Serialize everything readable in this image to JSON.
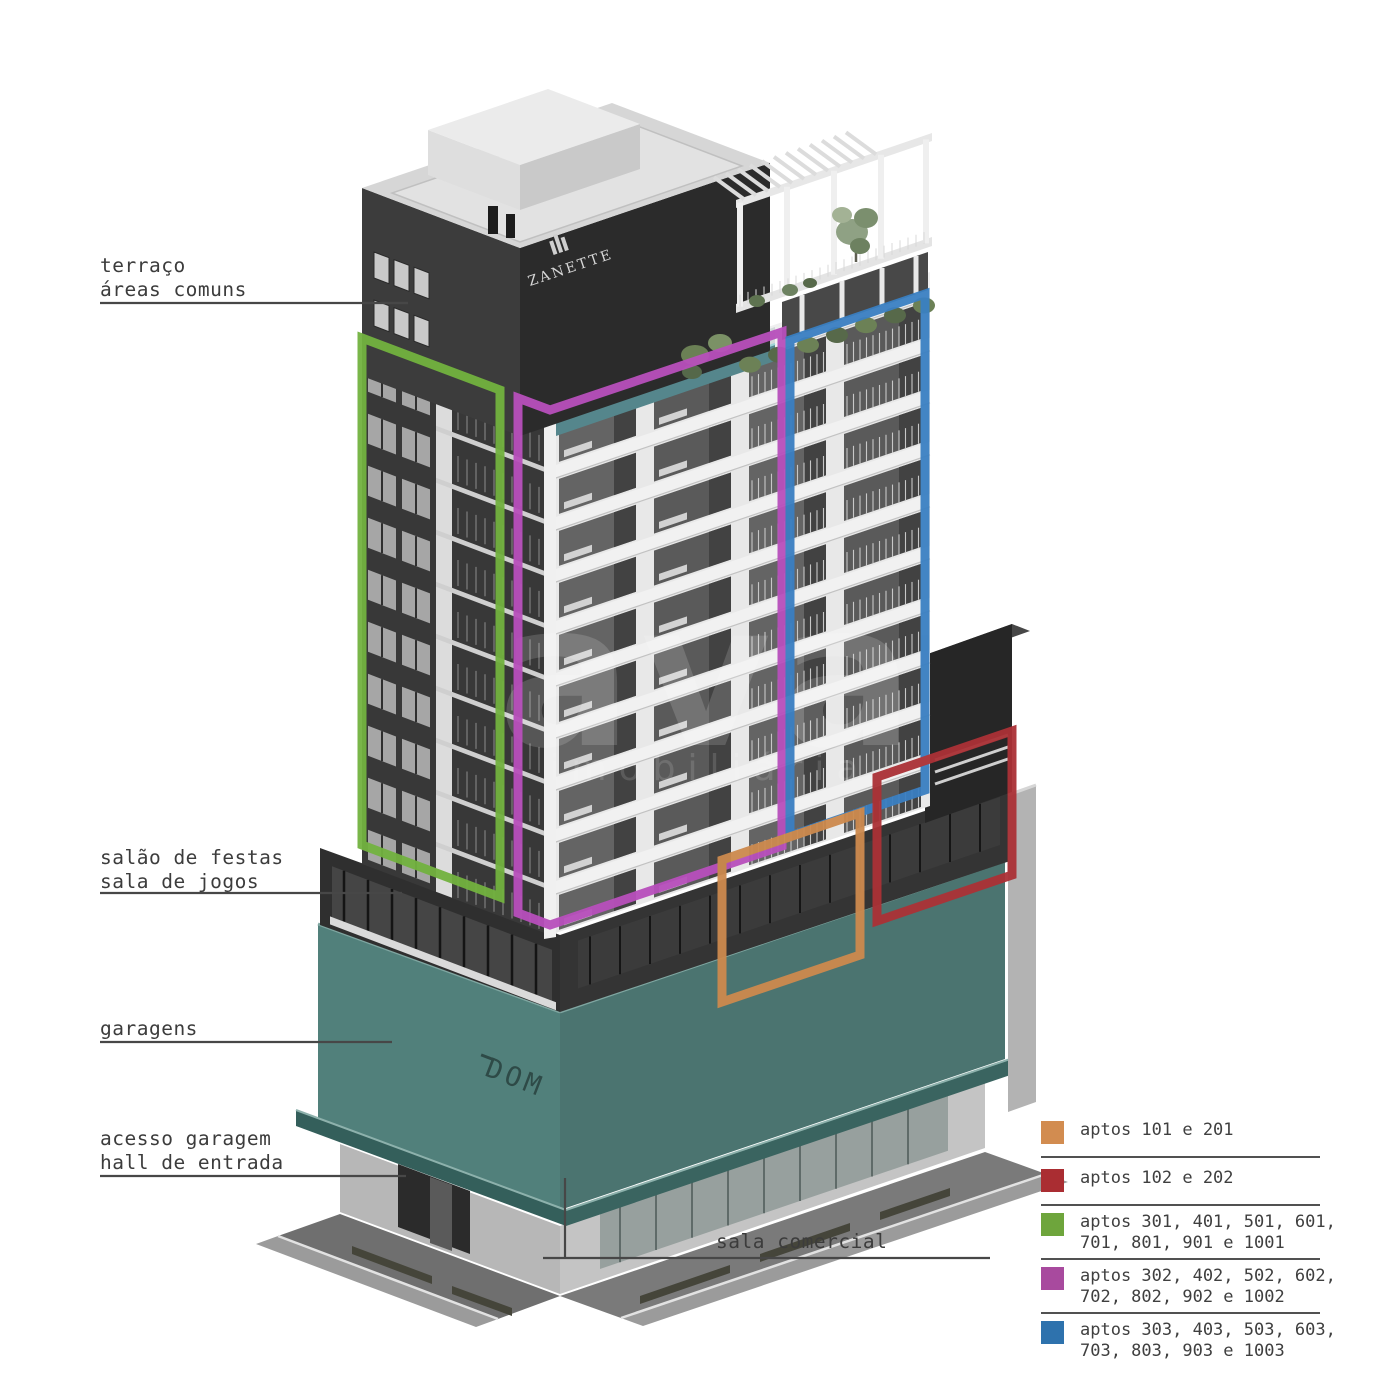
{
  "page": {
    "background": "#ffffff"
  },
  "annotations": [
    {
      "id": "terraco",
      "lines": [
        "terraço",
        "áreas comuns"
      ]
    },
    {
      "id": "salao",
      "lines": [
        "salão de festas",
        "sala de jogos"
      ]
    },
    {
      "id": "garagens",
      "lines": [
        "garagens"
      ]
    },
    {
      "id": "acesso",
      "lines": [
        "acesso garagem",
        "hall de entrada"
      ]
    },
    {
      "id": "sala-comercial",
      "lines": [
        "sala comercial"
      ]
    }
  ],
  "legend": {
    "items": [
      {
        "color": "#d28c50",
        "label_line1": "aptos 101 e 201"
      },
      {
        "color": "#aa2d32",
        "label_line1": "aptos 102 e 202"
      },
      {
        "color": "#6ea53c",
        "label_line1": "aptos 301, 401, 501, 601,",
        "label_line2": "701, 801, 901 e 1001"
      },
      {
        "color": "#a84a9e",
        "label_line1": "aptos 302, 402, 502, 602,",
        "label_line2": "702, 802, 902 e 1002"
      },
      {
        "color": "#2e72ad",
        "label_line1": "aptos 303, 403, 503, 603,",
        "label_line2": "703, 803, 903 e 1003"
      }
    ]
  },
  "building_signs": {
    "tower_logo": "ZANETTE",
    "garage_sign": "DOM"
  },
  "watermark": {
    "text": "ava",
    "subtext": "imobiliária"
  },
  "overlay_colors": {
    "green": "#72b23f",
    "magenta": "#b84fbc",
    "blue": "#3a7fc2",
    "orange": "#cd8a4e",
    "red": "#ab3136"
  }
}
